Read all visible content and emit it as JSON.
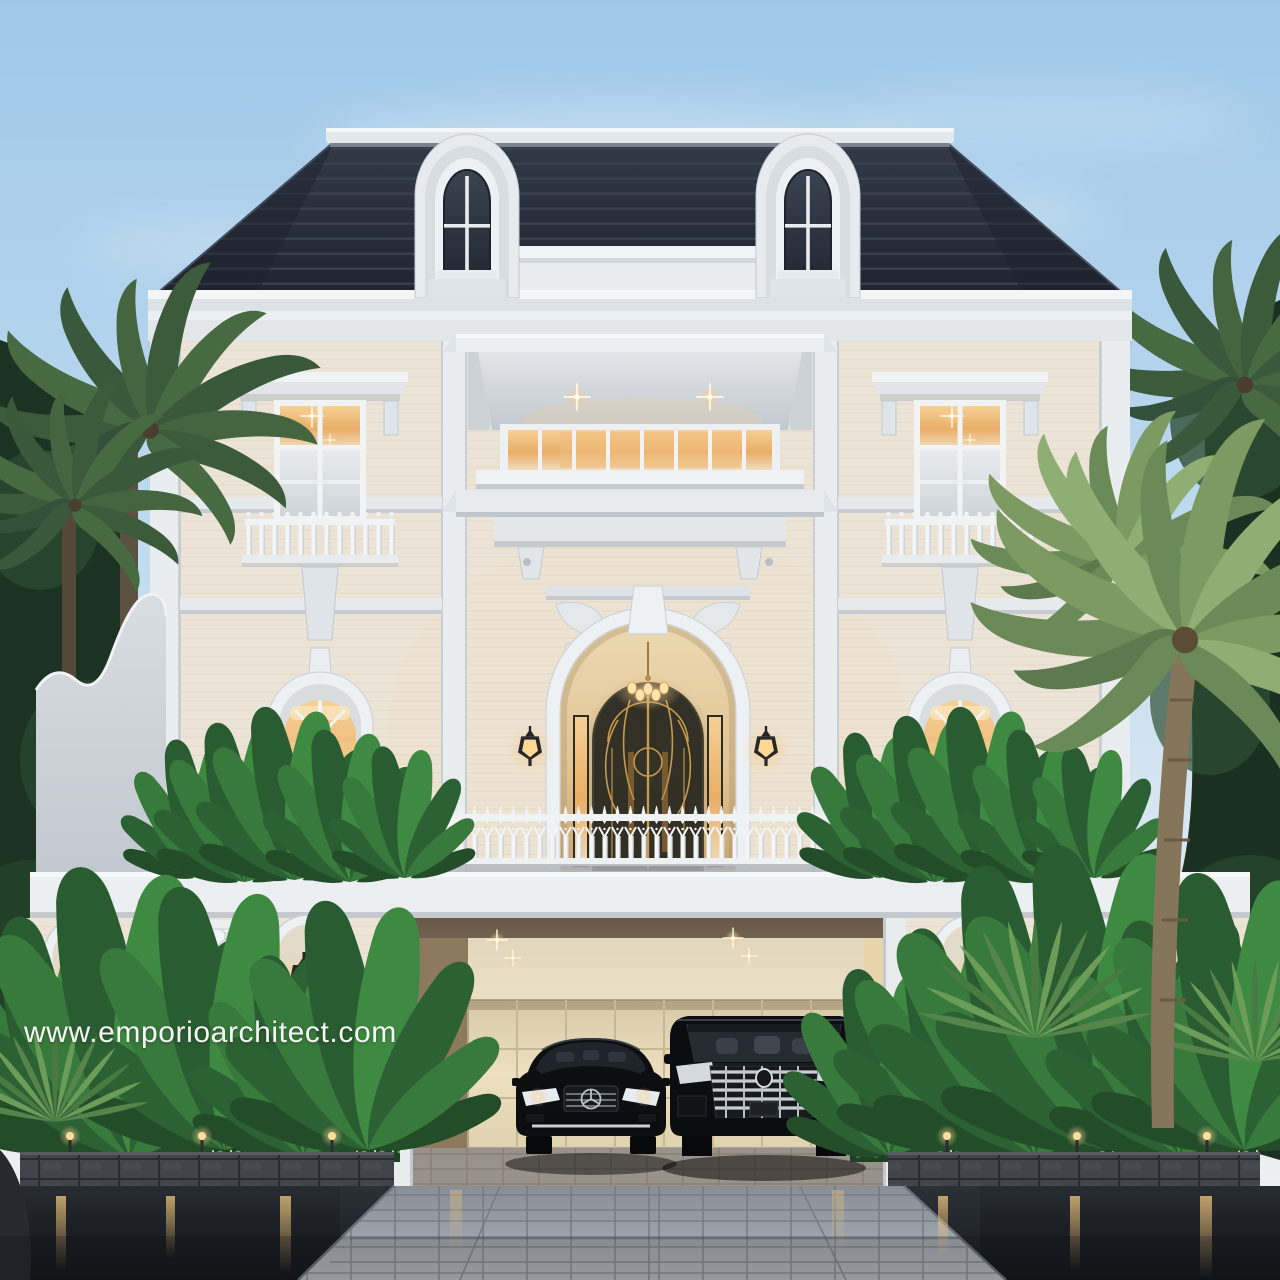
{
  "watermark": {
    "text": "www.emporioarchitect.com"
  },
  "palette": {
    "sky_top": "#9fc8e8",
    "sky_horizon": "#eff1f1",
    "roof": "#272c38",
    "facade_travertine": "#ece5d7",
    "trim_white": "#eef1f3",
    "window_glow": "#e9ae66",
    "foliage_dark": "#1c3222",
    "foliage_bright": "#3f8a42",
    "asphalt": "#1a1e23",
    "car_black": "#0c0d10",
    "watermark": "#ffffff"
  }
}
